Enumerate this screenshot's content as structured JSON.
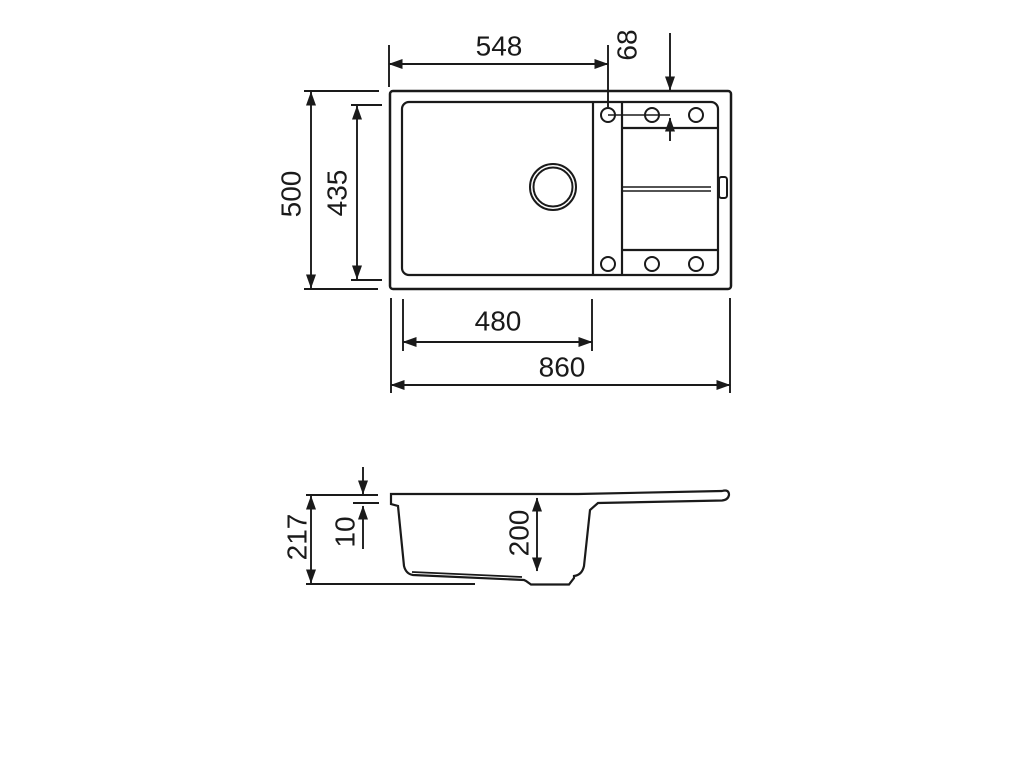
{
  "dimensions": {
    "top_view": {
      "total_width": "860",
      "total_depth": "500",
      "bowl_width": "480",
      "bowl_depth": "435",
      "edge_to_hole": "548",
      "hole_inset": "68"
    },
    "section_view": {
      "total_height": "217",
      "rim_thickness": "10",
      "bowl_inner_depth": "200"
    }
  },
  "colors": {
    "line": "#1a1a1a",
    "background": "#ffffff"
  }
}
